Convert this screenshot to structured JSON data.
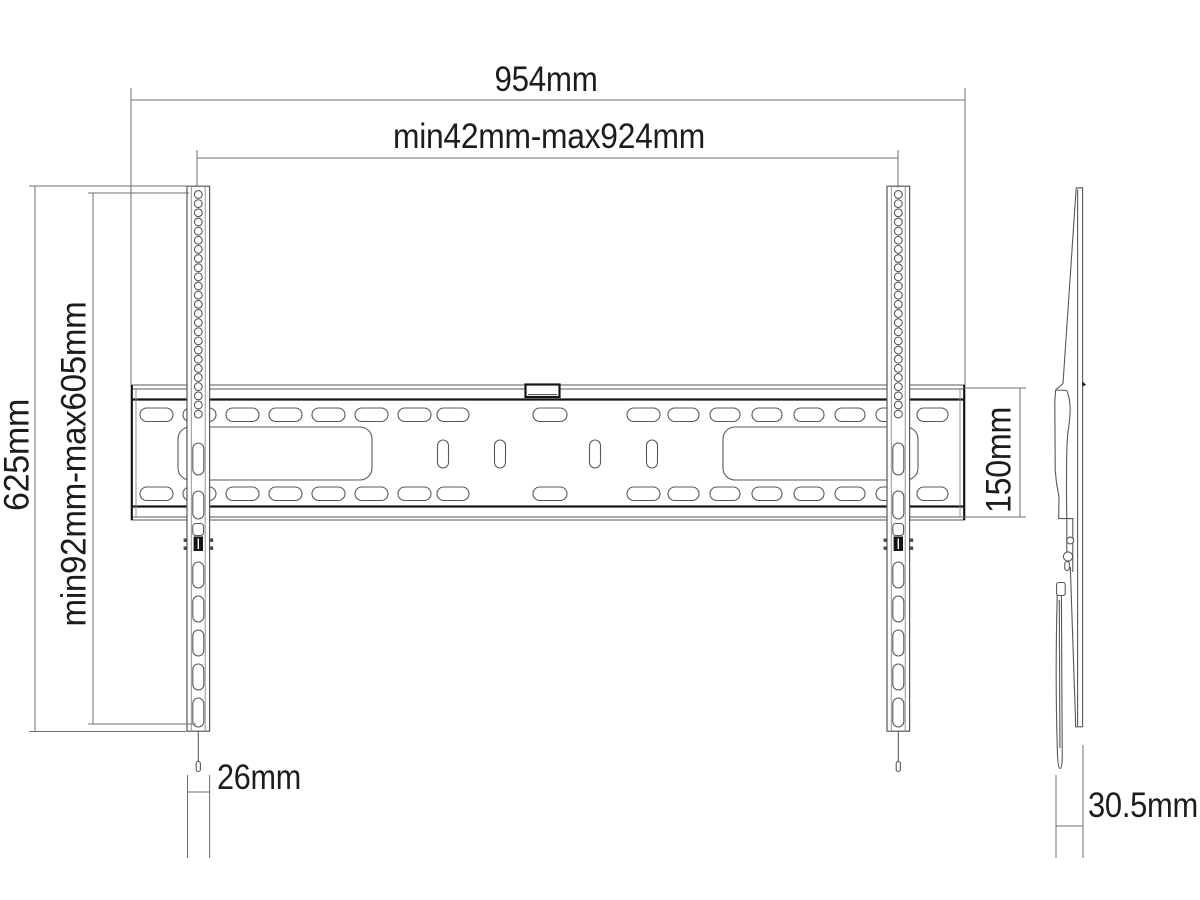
{
  "drawing": {
    "kind": "tv-wall-mount-dimension-drawing",
    "labels": {
      "overall_width": "954mm",
      "hole_width_range": "min42mm-max924mm",
      "overall_height": "625mm",
      "hole_height_range": "min92mm-max605mm",
      "rail_height": "150mm",
      "bracket_width": "26mm",
      "depth": "30.5mm"
    },
    "colors": {
      "background": "#ffffff",
      "thin_line": "#585858",
      "bold_line": "#161616",
      "dimension_line": "#6f6f6f",
      "text": "#1c1c1c",
      "latch_fill": "#141414"
    }
  }
}
